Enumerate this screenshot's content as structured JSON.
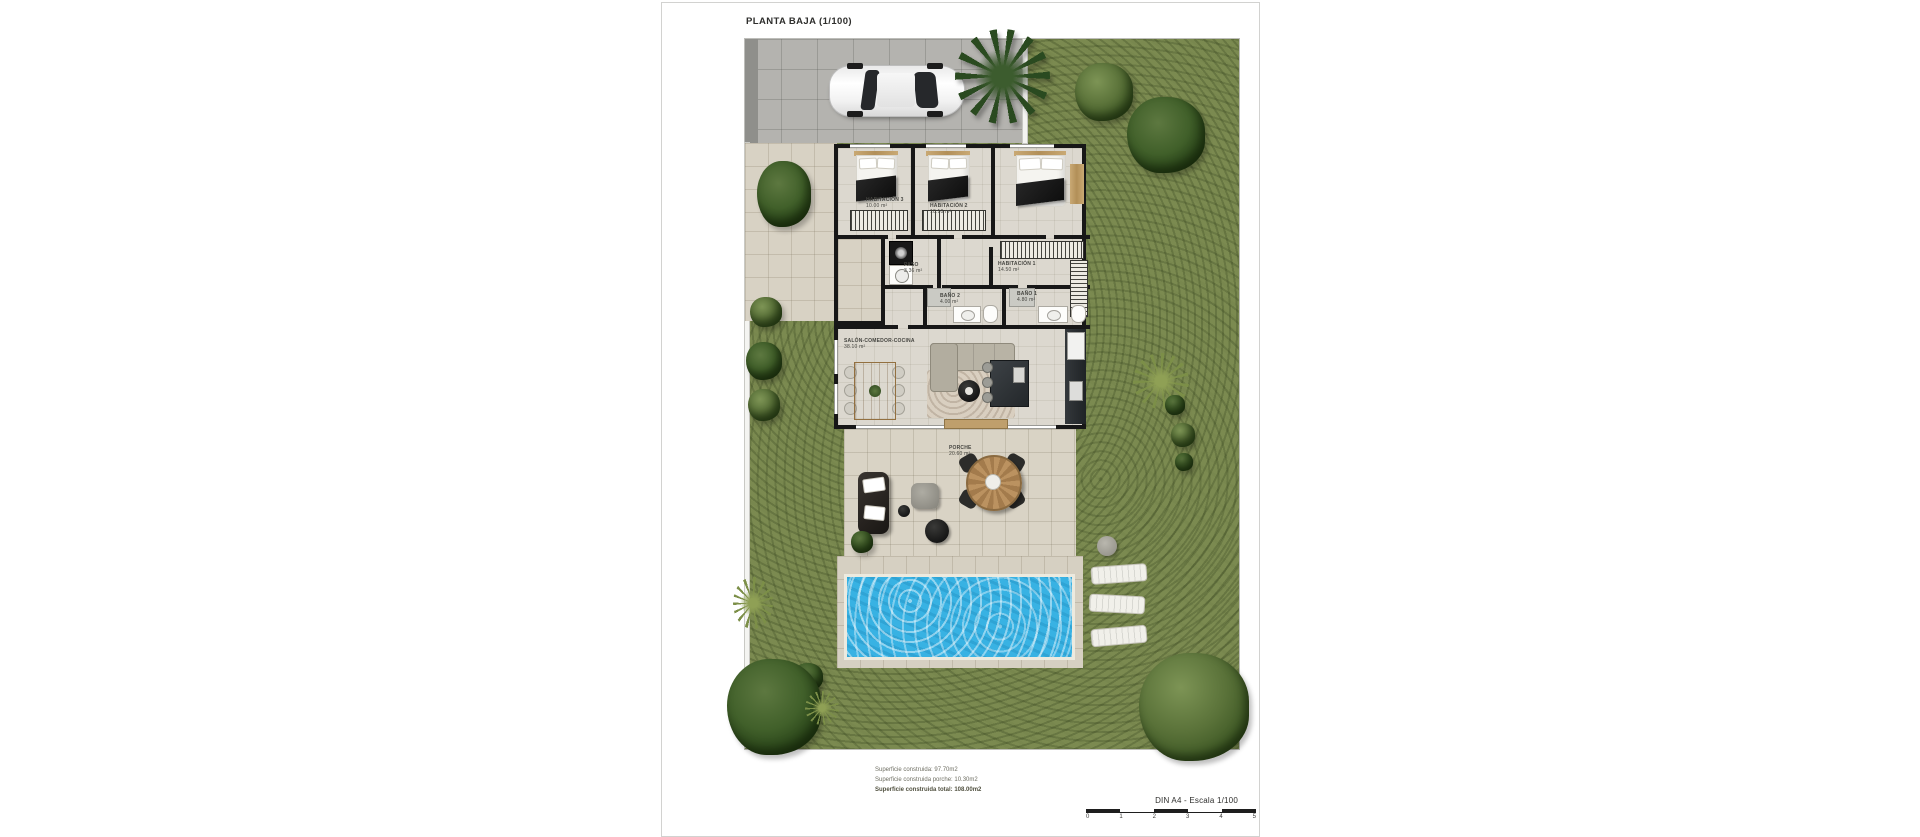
{
  "sheet": {
    "title": "PLANTA BAJA (1/100)"
  },
  "rooms": {
    "hab3": {
      "name": "HABITACIÓN 3",
      "area": "10.00 m²"
    },
    "hab2": {
      "name": "HABITACIÓN 2",
      "area": "10.10 m²"
    },
    "hab1": {
      "name": "HABITACIÓN 1",
      "area": "14.50 m²"
    },
    "paso": {
      "name": "PASO",
      "area": "3.36 m²"
    },
    "bano2": {
      "name": "BAÑO 2",
      "area": "4.00 m²"
    },
    "bano1": {
      "name": "BAÑO 1",
      "area": "4.80 m²"
    },
    "salon": {
      "name": "SALÓN-COMEDOR-COCINA",
      "area": "38.10 m²"
    },
    "porche": {
      "name": "PORCHE",
      "area": "20.60 m²"
    }
  },
  "summary": {
    "built": "Superficie construida: 97.70m2",
    "porch": "Superficie construida porche: 10.30m2",
    "total": "Superficie construida total: 108.00m2"
  },
  "scalebar": {
    "label": "DIN A4 - Escala 1/100",
    "ticks": [
      "0",
      "1",
      "2",
      "3",
      "4",
      "5"
    ]
  },
  "colors": {
    "grass": "#7b8a50",
    "pavement": "#d8d2c4",
    "driveway": "#b4b3af",
    "wall": "#171717",
    "pool_water": "#38b2e3"
  }
}
